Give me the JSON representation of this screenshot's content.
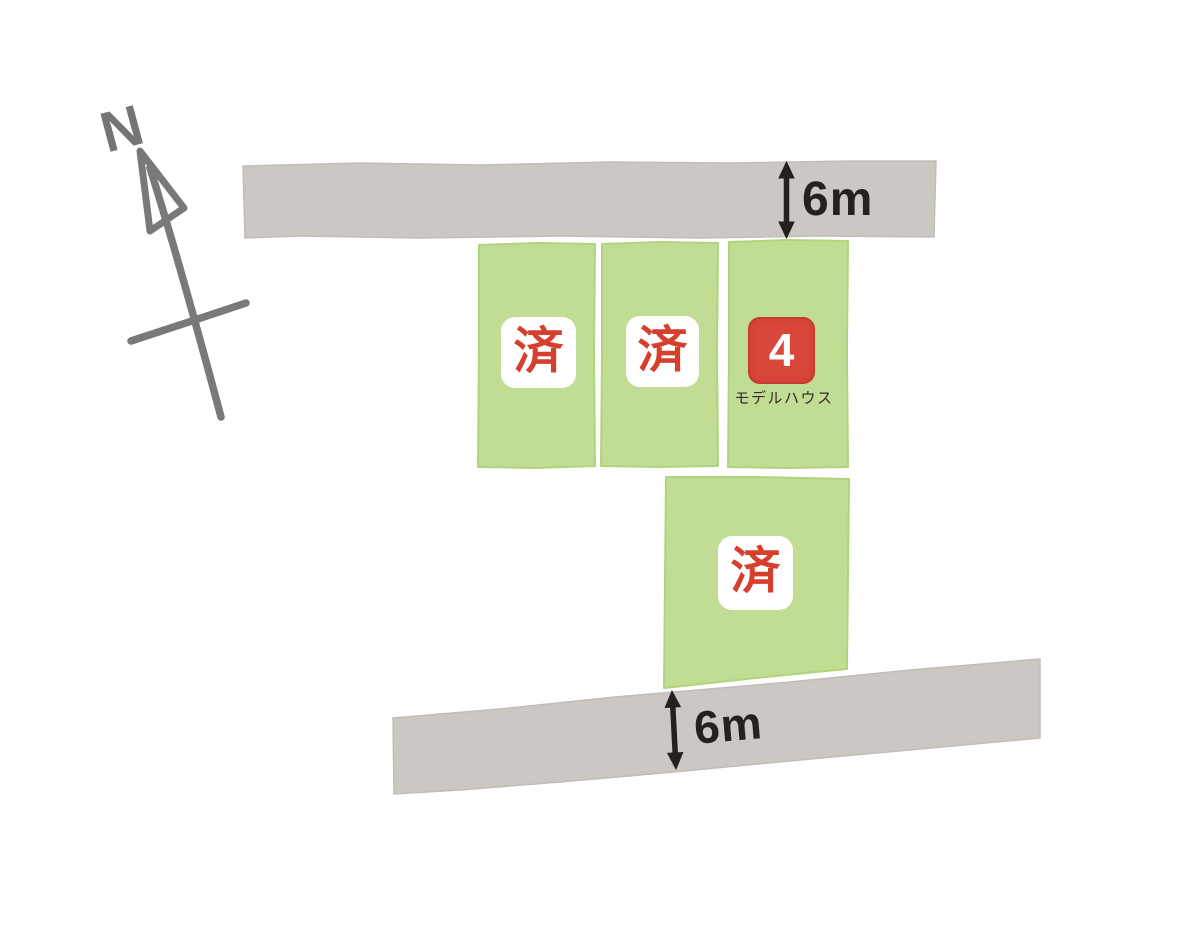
{
  "canvas": {
    "width": 1200,
    "height": 938,
    "background": "#ffffff"
  },
  "compass": {
    "north_label": "N"
  },
  "roads": {
    "top": {
      "width_label": "6m"
    },
    "bottom": {
      "width_label": "6m"
    }
  },
  "plots": {
    "top_row": [
      {
        "name": "plot-1",
        "status_label": "済"
      },
      {
        "name": "plot-2",
        "status_label": "済"
      },
      {
        "name": "plot-4",
        "number_label": "4",
        "caption": "モデルハウス"
      }
    ],
    "lower": {
      "name": "plot-3",
      "status_label": "済"
    }
  },
  "colors": {
    "road_gray": "#cbc7c3",
    "plot_green": "#c1dd94",
    "badge_white": "#ffffff",
    "sold_stamp_red": "#d5402e",
    "model_house_badge_red": "#d9463a",
    "dimension_text": "#262020",
    "compass_gray": "#7a7977",
    "caption_text": "#332c29"
  }
}
